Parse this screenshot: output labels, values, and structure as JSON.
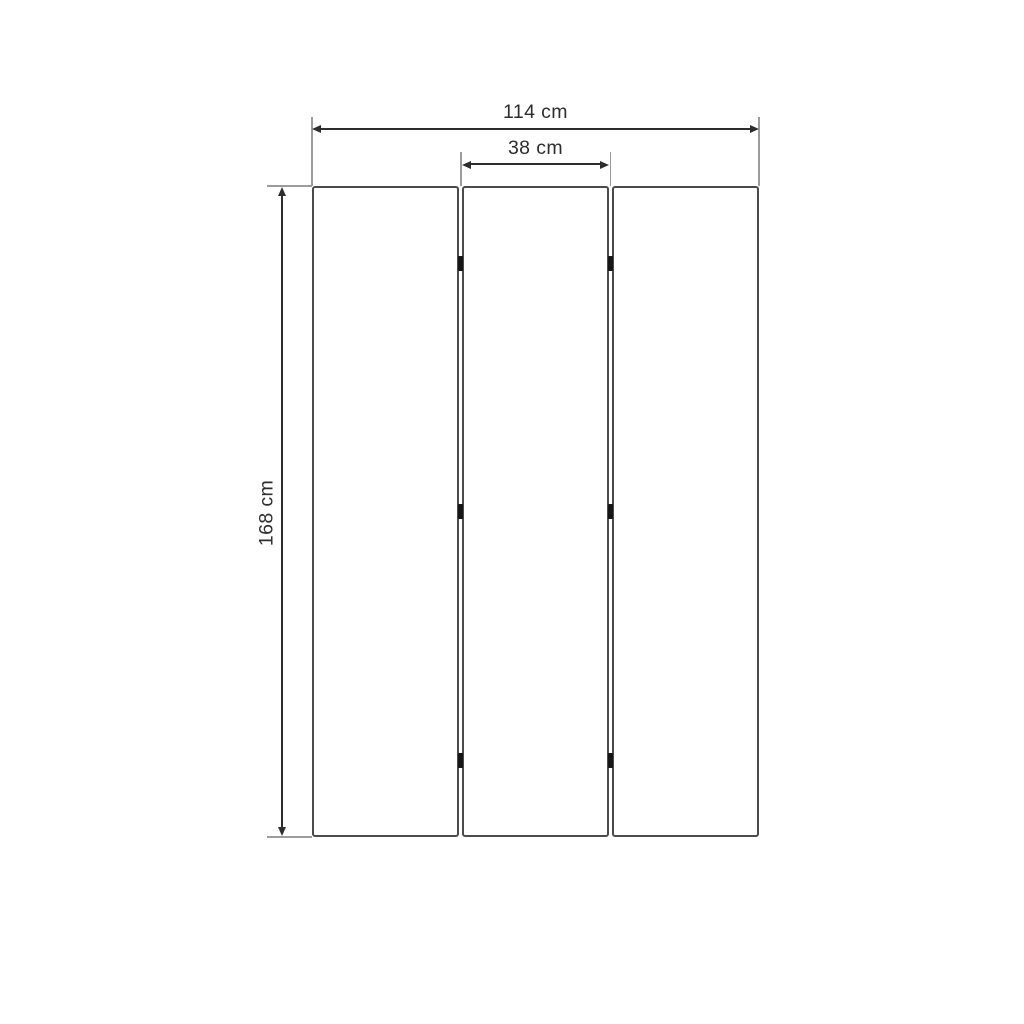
{
  "diagram": {
    "kind": "dimension-drawing",
    "labels": {
      "total_width": "114 cm",
      "panel_width": "38 cm",
      "height": "168 cm"
    },
    "panels": {
      "count": 3,
      "hinge_count": 6
    },
    "colors": {
      "background": "#ffffff",
      "panel_border": "#4b4b4b",
      "dimension_line": "#2d2d2d",
      "extension_line": "#9c9c9c",
      "hinge": "#161616",
      "label_text": "#2d2d2d"
    }
  }
}
